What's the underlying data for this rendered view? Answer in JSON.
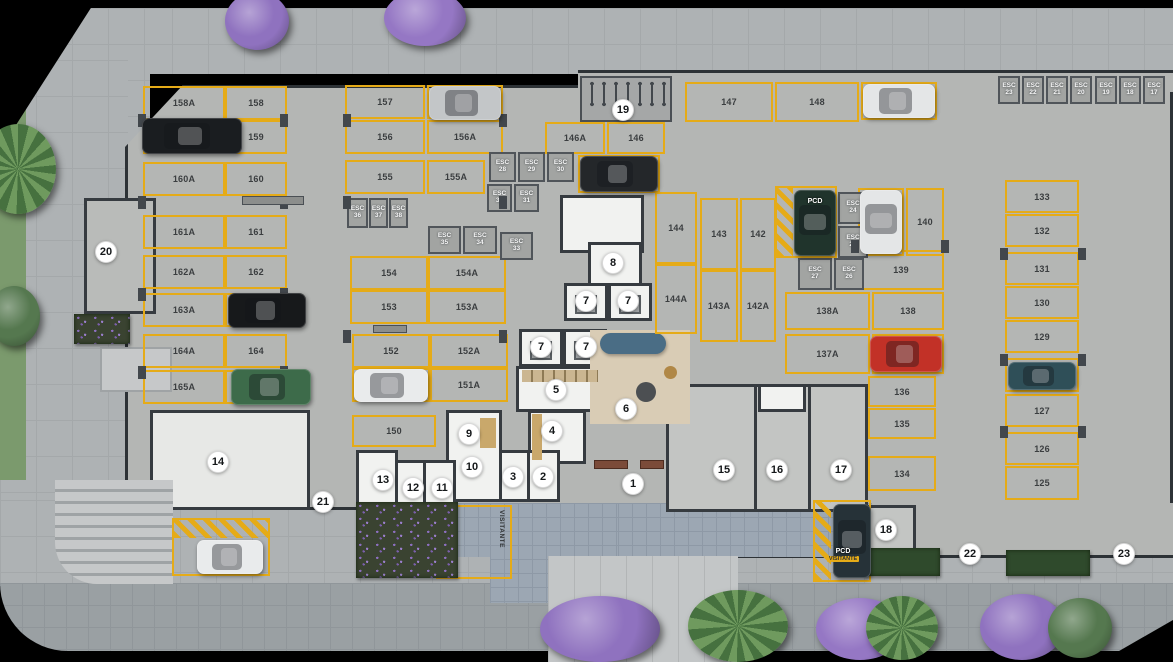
{
  "labels": {
    "esc": "ESC",
    "pcd": "PCD",
    "visitante": "VISITANTE"
  },
  "colors": {
    "slab": "#b4b6b4",
    "sidewalk": "#aeb2b4",
    "street": "#9aa0a3",
    "spot_line": "#e5ab18",
    "wall": "#363b40",
    "key_bg": "#ffffff",
    "pavers_blue": "#9ca7b3",
    "rug": "#d9ccb5",
    "sofa": "#4a6d85"
  },
  "spots": [
    {
      "n": "158A",
      "x": 143,
      "y": 86,
      "w": 82,
      "h": 34
    },
    {
      "n": "158",
      "x": 225,
      "y": 86,
      "w": 62,
      "h": 34
    },
    {
      "n": "159A",
      "x": 143,
      "y": 120,
      "w": 82,
      "h": 34
    },
    {
      "n": "159",
      "x": 225,
      "y": 120,
      "w": 62,
      "h": 34
    },
    {
      "n": "160A",
      "x": 143,
      "y": 162,
      "w": 82,
      "h": 34
    },
    {
      "n": "160",
      "x": 225,
      "y": 162,
      "w": 62,
      "h": 34
    },
    {
      "n": "161A",
      "x": 143,
      "y": 215,
      "w": 82,
      "h": 34
    },
    {
      "n": "161",
      "x": 225,
      "y": 215,
      "w": 62,
      "h": 34
    },
    {
      "n": "162A",
      "x": 143,
      "y": 255,
      "w": 82,
      "h": 34
    },
    {
      "n": "162",
      "x": 225,
      "y": 255,
      "w": 62,
      "h": 34
    },
    {
      "n": "163A",
      "x": 143,
      "y": 293,
      "w": 82,
      "h": 34
    },
    {
      "n": "163",
      "x": 225,
      "y": 293,
      "w": 62,
      "h": 34
    },
    {
      "n": "164A",
      "x": 143,
      "y": 334,
      "w": 82,
      "h": 34
    },
    {
      "n": "164",
      "x": 225,
      "y": 334,
      "w": 62,
      "h": 34
    },
    {
      "n": "165A",
      "x": 143,
      "y": 370,
      "w": 82,
      "h": 34
    },
    {
      "n": "165",
      "x": 225,
      "y": 370,
      "w": 62,
      "h": 34
    },
    {
      "n": "157",
      "x": 345,
      "y": 85,
      "w": 80,
      "h": 34
    },
    {
      "n": "157A",
      "x": 427,
      "y": 85,
      "w": 76,
      "h": 34
    },
    {
      "n": "156",
      "x": 345,
      "y": 120,
      "w": 80,
      "h": 34
    },
    {
      "n": "156A",
      "x": 427,
      "y": 120,
      "w": 76,
      "h": 34
    },
    {
      "n": "155",
      "x": 345,
      "y": 160,
      "w": 80,
      "h": 34
    },
    {
      "n": "155A",
      "x": 427,
      "y": 160,
      "w": 58,
      "h": 34
    },
    {
      "n": "154",
      "x": 350,
      "y": 256,
      "w": 78,
      "h": 34
    },
    {
      "n": "154A",
      "x": 428,
      "y": 256,
      "w": 78,
      "h": 34
    },
    {
      "n": "153",
      "x": 350,
      "y": 290,
      "w": 78,
      "h": 34
    },
    {
      "n": "153A",
      "x": 428,
      "y": 290,
      "w": 78,
      "h": 34
    },
    {
      "n": "152",
      "x": 352,
      "y": 334,
      "w": 78,
      "h": 34
    },
    {
      "n": "152A",
      "x": 430,
      "y": 334,
      "w": 78,
      "h": 34
    },
    {
      "n": "151",
      "x": 352,
      "y": 368,
      "w": 78,
      "h": 34
    },
    {
      "n": "151A",
      "x": 430,
      "y": 368,
      "w": 78,
      "h": 34
    },
    {
      "n": "150",
      "x": 352,
      "y": 415,
      "w": 84,
      "h": 32
    },
    {
      "n": "147",
      "x": 685,
      "y": 82,
      "w": 88,
      "h": 40
    },
    {
      "n": "148",
      "x": 775,
      "y": 82,
      "w": 84,
      "h": 40
    },
    {
      "n": "149",
      "x": 861,
      "y": 82,
      "w": 76,
      "h": 38
    },
    {
      "n": "146A",
      "x": 545,
      "y": 122,
      "w": 60,
      "h": 32
    },
    {
      "n": "146",
      "x": 607,
      "y": 122,
      "w": 58,
      "h": 32
    },
    {
      "n": "145",
      "x": 578,
      "y": 155,
      "w": 82,
      "h": 38
    },
    {
      "n": "144",
      "x": 655,
      "y": 192,
      "w": 42,
      "h": 72
    },
    {
      "n": "143",
      "x": 700,
      "y": 198,
      "w": 38,
      "h": 72
    },
    {
      "n": "142",
      "x": 740,
      "y": 198,
      "w": 36,
      "h": 72
    },
    {
      "n": "144A",
      "x": 655,
      "y": 264,
      "w": 42,
      "h": 70
    },
    {
      "n": "143A",
      "x": 700,
      "y": 270,
      "w": 38,
      "h": 72
    },
    {
      "n": "142A",
      "x": 740,
      "y": 270,
      "w": 36,
      "h": 72
    },
    {
      "n": "141",
      "x": 858,
      "y": 188,
      "w": 46,
      "h": 68
    },
    {
      "n": "140",
      "x": 906,
      "y": 188,
      "w": 38,
      "h": 68
    },
    {
      "n": "139",
      "x": 858,
      "y": 250,
      "w": 86,
      "h": 40
    },
    {
      "n": "138A",
      "x": 785,
      "y": 292,
      "w": 85,
      "h": 38
    },
    {
      "n": "138",
      "x": 872,
      "y": 292,
      "w": 72,
      "h": 38
    },
    {
      "n": "137A",
      "x": 785,
      "y": 334,
      "w": 85,
      "h": 40
    },
    {
      "n": "137",
      "x": 872,
      "y": 334,
      "w": 72,
      "h": 40
    },
    {
      "n": "136",
      "x": 868,
      "y": 376,
      "w": 68,
      "h": 31
    },
    {
      "n": "135",
      "x": 868,
      "y": 408,
      "w": 68,
      "h": 31
    },
    {
      "n": "134",
      "x": 868,
      "y": 456,
      "w": 68,
      "h": 35
    },
    {
      "n": "133",
      "x": 1005,
      "y": 180,
      "w": 74,
      "h": 33
    },
    {
      "n": "132",
      "x": 1005,
      "y": 214,
      "w": 74,
      "h": 33
    },
    {
      "n": "131",
      "x": 1005,
      "y": 252,
      "w": 74,
      "h": 33
    },
    {
      "n": "130",
      "x": 1005,
      "y": 286,
      "w": 74,
      "h": 33
    },
    {
      "n": "129",
      "x": 1005,
      "y": 320,
      "w": 74,
      "h": 33
    },
    {
      "n": "128",
      "x": 1005,
      "y": 358,
      "w": 74,
      "h": 34
    },
    {
      "n": "127",
      "x": 1005,
      "y": 394,
      "w": 74,
      "h": 33
    },
    {
      "n": "126",
      "x": 1005,
      "y": 432,
      "w": 74,
      "h": 33
    },
    {
      "n": "125",
      "x": 1005,
      "y": 466,
      "w": 74,
      "h": 34
    }
  ],
  "esc_lockers": [
    {
      "n": "23",
      "x": 998,
      "y": 76,
      "w": 22,
      "h": 28
    },
    {
      "n": "22",
      "x": 1022,
      "y": 76,
      "w": 22,
      "h": 28
    },
    {
      "n": "21",
      "x": 1046,
      "y": 76,
      "w": 22,
      "h": 28
    },
    {
      "n": "20",
      "x": 1070,
      "y": 76,
      "w": 22,
      "h": 28
    },
    {
      "n": "19",
      "x": 1095,
      "y": 76,
      "w": 22,
      "h": 28
    },
    {
      "n": "18",
      "x": 1119,
      "y": 76,
      "w": 22,
      "h": 28
    },
    {
      "n": "17",
      "x": 1143,
      "y": 76,
      "w": 22,
      "h": 28
    },
    {
      "n": "28",
      "x": 489,
      "y": 152,
      "w": 27,
      "h": 30
    },
    {
      "n": "29",
      "x": 518,
      "y": 152,
      "w": 27,
      "h": 30
    },
    {
      "n": "30",
      "x": 547,
      "y": 152,
      "w": 27,
      "h": 30
    },
    {
      "n": "32",
      "x": 487,
      "y": 184,
      "w": 25,
      "h": 28
    },
    {
      "n": "31",
      "x": 514,
      "y": 184,
      "w": 25,
      "h": 28
    },
    {
      "n": "36",
      "x": 347,
      "y": 198,
      "w": 21,
      "h": 30
    },
    {
      "n": "37",
      "x": 369,
      "y": 198,
      "w": 19,
      "h": 30
    },
    {
      "n": "38",
      "x": 389,
      "y": 198,
      "w": 19,
      "h": 30
    },
    {
      "n": "35",
      "x": 428,
      "y": 226,
      "w": 33,
      "h": 28
    },
    {
      "n": "34",
      "x": 463,
      "y": 226,
      "w": 34,
      "h": 28
    },
    {
      "n": "33",
      "x": 500,
      "y": 232,
      "w": 33,
      "h": 28
    },
    {
      "n": "24",
      "x": 838,
      "y": 192,
      "w": 30,
      "h": 32
    },
    {
      "n": "25",
      "x": 838,
      "y": 226,
      "w": 30,
      "h": 32
    },
    {
      "n": "27",
      "x": 798,
      "y": 258,
      "w": 34,
      "h": 32
    },
    {
      "n": "26",
      "x": 834,
      "y": 258,
      "w": 30,
      "h": 32
    }
  ],
  "keys": [
    {
      "n": "1",
      "x": 633,
      "y": 484
    },
    {
      "n": "2",
      "x": 543,
      "y": 477
    },
    {
      "n": "3",
      "x": 513,
      "y": 477
    },
    {
      "n": "4",
      "x": 552,
      "y": 431
    },
    {
      "n": "5",
      "x": 556,
      "y": 390
    },
    {
      "n": "6",
      "x": 626,
      "y": 409
    },
    {
      "n": "7",
      "x": 586,
      "y": 301
    },
    {
      "n": "7",
      "x": 628,
      "y": 301
    },
    {
      "n": "7",
      "x": 541,
      "y": 347
    },
    {
      "n": "7",
      "x": 586,
      "y": 347
    },
    {
      "n": "8",
      "x": 613,
      "y": 263
    },
    {
      "n": "9",
      "x": 469,
      "y": 434
    },
    {
      "n": "10",
      "x": 472,
      "y": 467
    },
    {
      "n": "11",
      "x": 442,
      "y": 488
    },
    {
      "n": "12",
      "x": 413,
      "y": 488
    },
    {
      "n": "13",
      "x": 383,
      "y": 480
    },
    {
      "n": "14",
      "x": 218,
      "y": 462
    },
    {
      "n": "15",
      "x": 724,
      "y": 470
    },
    {
      "n": "16",
      "x": 777,
      "y": 470
    },
    {
      "n": "17",
      "x": 841,
      "y": 470
    },
    {
      "n": "18",
      "x": 886,
      "y": 530
    },
    {
      "n": "19",
      "x": 623,
      "y": 110
    },
    {
      "n": "20",
      "x": 106,
      "y": 252
    },
    {
      "n": "21",
      "x": 323,
      "y": 502
    },
    {
      "n": "22",
      "x": 970,
      "y": 554
    },
    {
      "n": "23",
      "x": 1124,
      "y": 554
    }
  ],
  "cars": [
    {
      "x": 142,
      "y": 118,
      "w": 100,
      "h": 36,
      "c": "#1a1d20",
      "cls": "h"
    },
    {
      "x": 429,
      "y": 86,
      "w": 72,
      "h": 34,
      "c": "#c3c6c8",
      "cls": "h"
    },
    {
      "x": 580,
      "y": 156,
      "w": 78,
      "h": 36,
      "c": "#24272a",
      "cls": "h"
    },
    {
      "x": 863,
      "y": 84,
      "w": 72,
      "h": 34,
      "c": "#e4e6e7",
      "cls": "h"
    },
    {
      "x": 794,
      "y": 190,
      "w": 42,
      "h": 66,
      "c": "#20342c",
      "cls": "v"
    },
    {
      "x": 860,
      "y": 190,
      "w": 42,
      "h": 64,
      "c": "#e4e6e7",
      "cls": "v"
    },
    {
      "x": 870,
      "y": 336,
      "w": 72,
      "h": 36,
      "c": "#c23127",
      "cls": "h"
    },
    {
      "x": 1008,
      "y": 362,
      "w": 68,
      "h": 28,
      "c": "#2f4f58",
      "cls": "h"
    },
    {
      "x": 354,
      "y": 369,
      "w": 74,
      "h": 33,
      "c": "#e9ebec",
      "cls": "h"
    },
    {
      "x": 228,
      "y": 293,
      "w": 78,
      "h": 35,
      "c": "#17191b",
      "cls": "h"
    },
    {
      "x": 231,
      "y": 369,
      "w": 80,
      "h": 36,
      "c": "#3d6b4a",
      "cls": "h"
    },
    {
      "x": 197,
      "y": 540,
      "w": 66,
      "h": 34,
      "c": "#e9ebec",
      "cls": "h"
    },
    {
      "x": 833,
      "y": 504,
      "w": 38,
      "h": 74,
      "c": "#263238",
      "cls": "v"
    }
  ],
  "trees": [
    {
      "x": 225,
      "y": -8,
      "w": 64,
      "h": 58,
      "c": "#8f72bf",
      "cls": "round"
    },
    {
      "x": 384,
      "y": -10,
      "w": 82,
      "h": 56,
      "c": "#9577c4",
      "cls": "round"
    },
    {
      "x": -20,
      "y": 124,
      "w": 76,
      "h": 90,
      "c": "#46713f",
      "cls": "palm"
    },
    {
      "x": -12,
      "y": 286,
      "w": 52,
      "h": 60,
      "c": "#55784f",
      "cls": "round"
    },
    {
      "x": 540,
      "y": 596,
      "w": 120,
      "h": 66,
      "c": "#8f72bf",
      "cls": "round"
    },
    {
      "x": 688,
      "y": 590,
      "w": 100,
      "h": 72,
      "c": "#46713f",
      "cls": "palm"
    },
    {
      "x": 816,
      "y": 598,
      "w": 88,
      "h": 62,
      "c": "#9577c4",
      "cls": "round"
    },
    {
      "x": 866,
      "y": 596,
      "w": 72,
      "h": 64,
      "c": "#46713f",
      "cls": "palm"
    },
    {
      "x": 980,
      "y": 594,
      "w": 84,
      "h": 66,
      "c": "#8f72bf",
      "cls": "round"
    },
    {
      "x": 1048,
      "y": 598,
      "w": 64,
      "h": 60,
      "c": "#55784f",
      "cls": "round"
    }
  ],
  "hedges": [
    {
      "x": 74,
      "y": 314,
      "w": 56,
      "h": 30,
      "cls": "flower"
    },
    {
      "x": 356,
      "y": 502,
      "w": 102,
      "h": 76,
      "cls": "flower"
    },
    {
      "x": 864,
      "y": 548,
      "w": 76,
      "h": 28,
      "cls": "green"
    },
    {
      "x": 1006,
      "y": 550,
      "w": 84,
      "h": 26,
      "cls": "green"
    }
  ],
  "pillars": [
    {
      "x": 138,
      "y": 114,
      "w": 8,
      "h": 13
    },
    {
      "x": 280,
      "y": 114,
      "w": 8,
      "h": 13
    },
    {
      "x": 138,
      "y": 196,
      "w": 8,
      "h": 13
    },
    {
      "x": 280,
      "y": 196,
      "w": 8,
      "h": 13
    },
    {
      "x": 138,
      "y": 288,
      "w": 8,
      "h": 13
    },
    {
      "x": 280,
      "y": 288,
      "w": 8,
      "h": 13
    },
    {
      "x": 138,
      "y": 366,
      "w": 8,
      "h": 13
    },
    {
      "x": 280,
      "y": 366,
      "w": 8,
      "h": 13
    },
    {
      "x": 343,
      "y": 114,
      "w": 8,
      "h": 13
    },
    {
      "x": 499,
      "y": 114,
      "w": 8,
      "h": 13
    },
    {
      "x": 343,
      "y": 196,
      "w": 8,
      "h": 13
    },
    {
      "x": 499,
      "y": 196,
      "w": 8,
      "h": 13
    },
    {
      "x": 343,
      "y": 330,
      "w": 8,
      "h": 13
    },
    {
      "x": 499,
      "y": 330,
      "w": 8,
      "h": 13
    },
    {
      "x": 851,
      "y": 240,
      "w": 8,
      "h": 13
    },
    {
      "x": 941,
      "y": 240,
      "w": 8,
      "h": 13
    },
    {
      "x": 1000,
      "y": 248,
      "w": 8,
      "h": 12
    },
    {
      "x": 1078,
      "y": 248,
      "w": 8,
      "h": 12
    },
    {
      "x": 1000,
      "y": 354,
      "w": 8,
      "h": 12
    },
    {
      "x": 1078,
      "y": 354,
      "w": 8,
      "h": 12
    },
    {
      "x": 1000,
      "y": 426,
      "w": 8,
      "h": 12
    },
    {
      "x": 1078,
      "y": 426,
      "w": 8,
      "h": 12
    }
  ],
  "beams": [
    {
      "x": 242,
      "y": 196,
      "w": 62,
      "h": 9
    },
    {
      "x": 373,
      "y": 325,
      "w": 34,
      "h": 8
    }
  ],
  "benches": [
    {
      "x": 594,
      "y": 460,
      "w": 34,
      "h": 9
    },
    {
      "x": 640,
      "y": 460,
      "w": 24,
      "h": 9
    }
  ],
  "bikes": [
    {
      "x": 588,
      "y": 80
    },
    {
      "x": 600,
      "y": 80
    },
    {
      "x": 612,
      "y": 80
    },
    {
      "x": 624,
      "y": 80
    },
    {
      "x": 636,
      "y": 80
    },
    {
      "x": 648,
      "y": 80
    },
    {
      "x": 660,
      "y": 80
    }
  ]
}
